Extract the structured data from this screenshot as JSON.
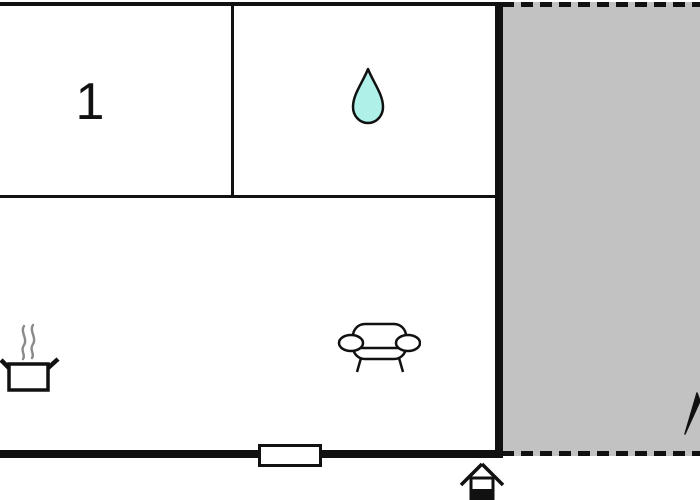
{
  "floor_plan": {
    "title": "vacation-home-floor-plan",
    "rooms": [
      {
        "id": "room-1",
        "label": "1",
        "position": "top-left"
      },
      {
        "id": "bathroom",
        "icon": "water-drop-icon",
        "position": "top-right"
      },
      {
        "id": "kitchen-living-room",
        "icons": [
          "cooking-pot-icon",
          "sofa-icon"
        ],
        "position": "bottom"
      },
      {
        "id": "terrace",
        "fill": "#c2c2c2",
        "border_style": "dashed",
        "position": "right"
      }
    ],
    "markers": {
      "entrance": "entrance-house-icon",
      "door_window": "door-window-marker",
      "north_arrow": "north-arrow-icon"
    },
    "colors": {
      "wall": "#111111",
      "terrace_fill": "#c2c2c2",
      "water_drop_fill": "#aff0e9",
      "steam_gray": "#8a8a8a",
      "background": "#ffffff"
    }
  }
}
